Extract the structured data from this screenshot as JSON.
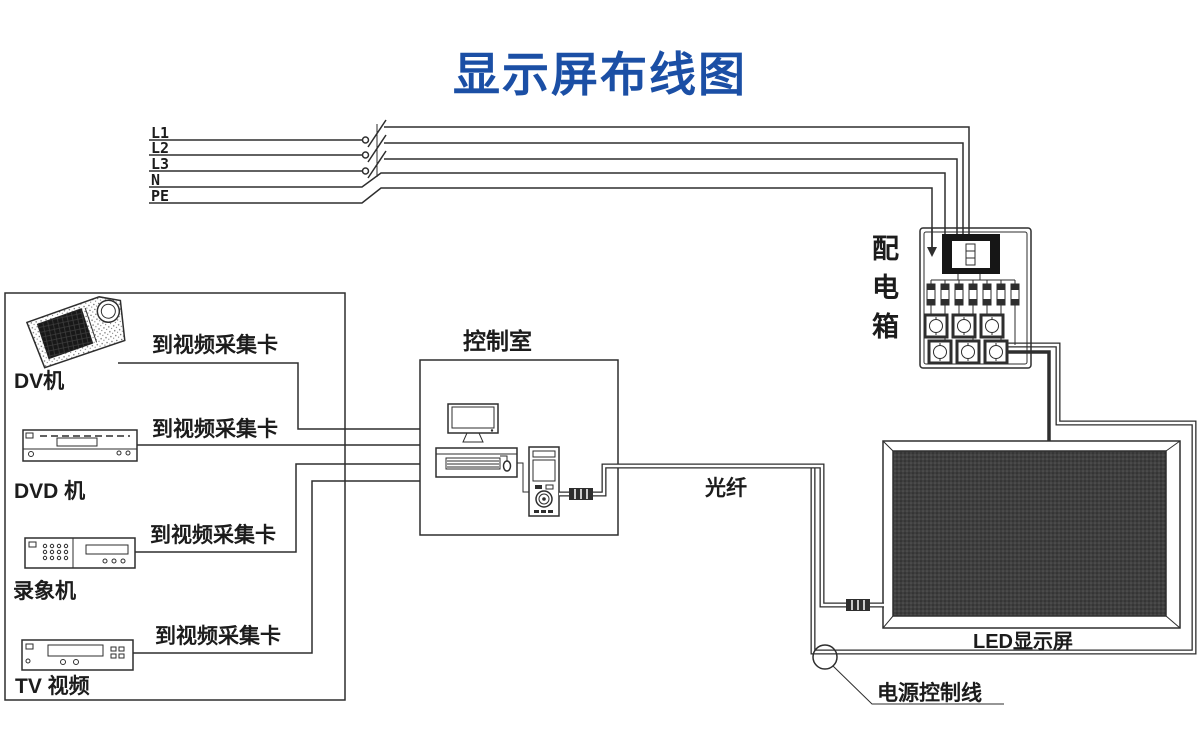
{
  "title": {
    "text": "显示屏布线图",
    "color": "#1b4fa5"
  },
  "mains": {
    "lines": [
      {
        "label": "L1"
      },
      {
        "label": "L2"
      },
      {
        "label": "L3"
      },
      {
        "label": "N"
      },
      {
        "label": "PE"
      }
    ]
  },
  "sources": {
    "wire_label": "到视频采集卡",
    "items": [
      {
        "label": "DV机"
      },
      {
        "label": "DVD 机"
      },
      {
        "label": "录象机"
      },
      {
        "label": "TV 视频"
      }
    ]
  },
  "control_room": {
    "label": "控制室"
  },
  "distribution_box": {
    "label": "配电箱"
  },
  "fiber": {
    "label": "光纤"
  },
  "led_display": {
    "label": "LED显示屏"
  },
  "power_control": {
    "label": "电源控制线"
  },
  "diagram": {
    "line_color": "#2e2e2e",
    "background": "#ffffff"
  }
}
